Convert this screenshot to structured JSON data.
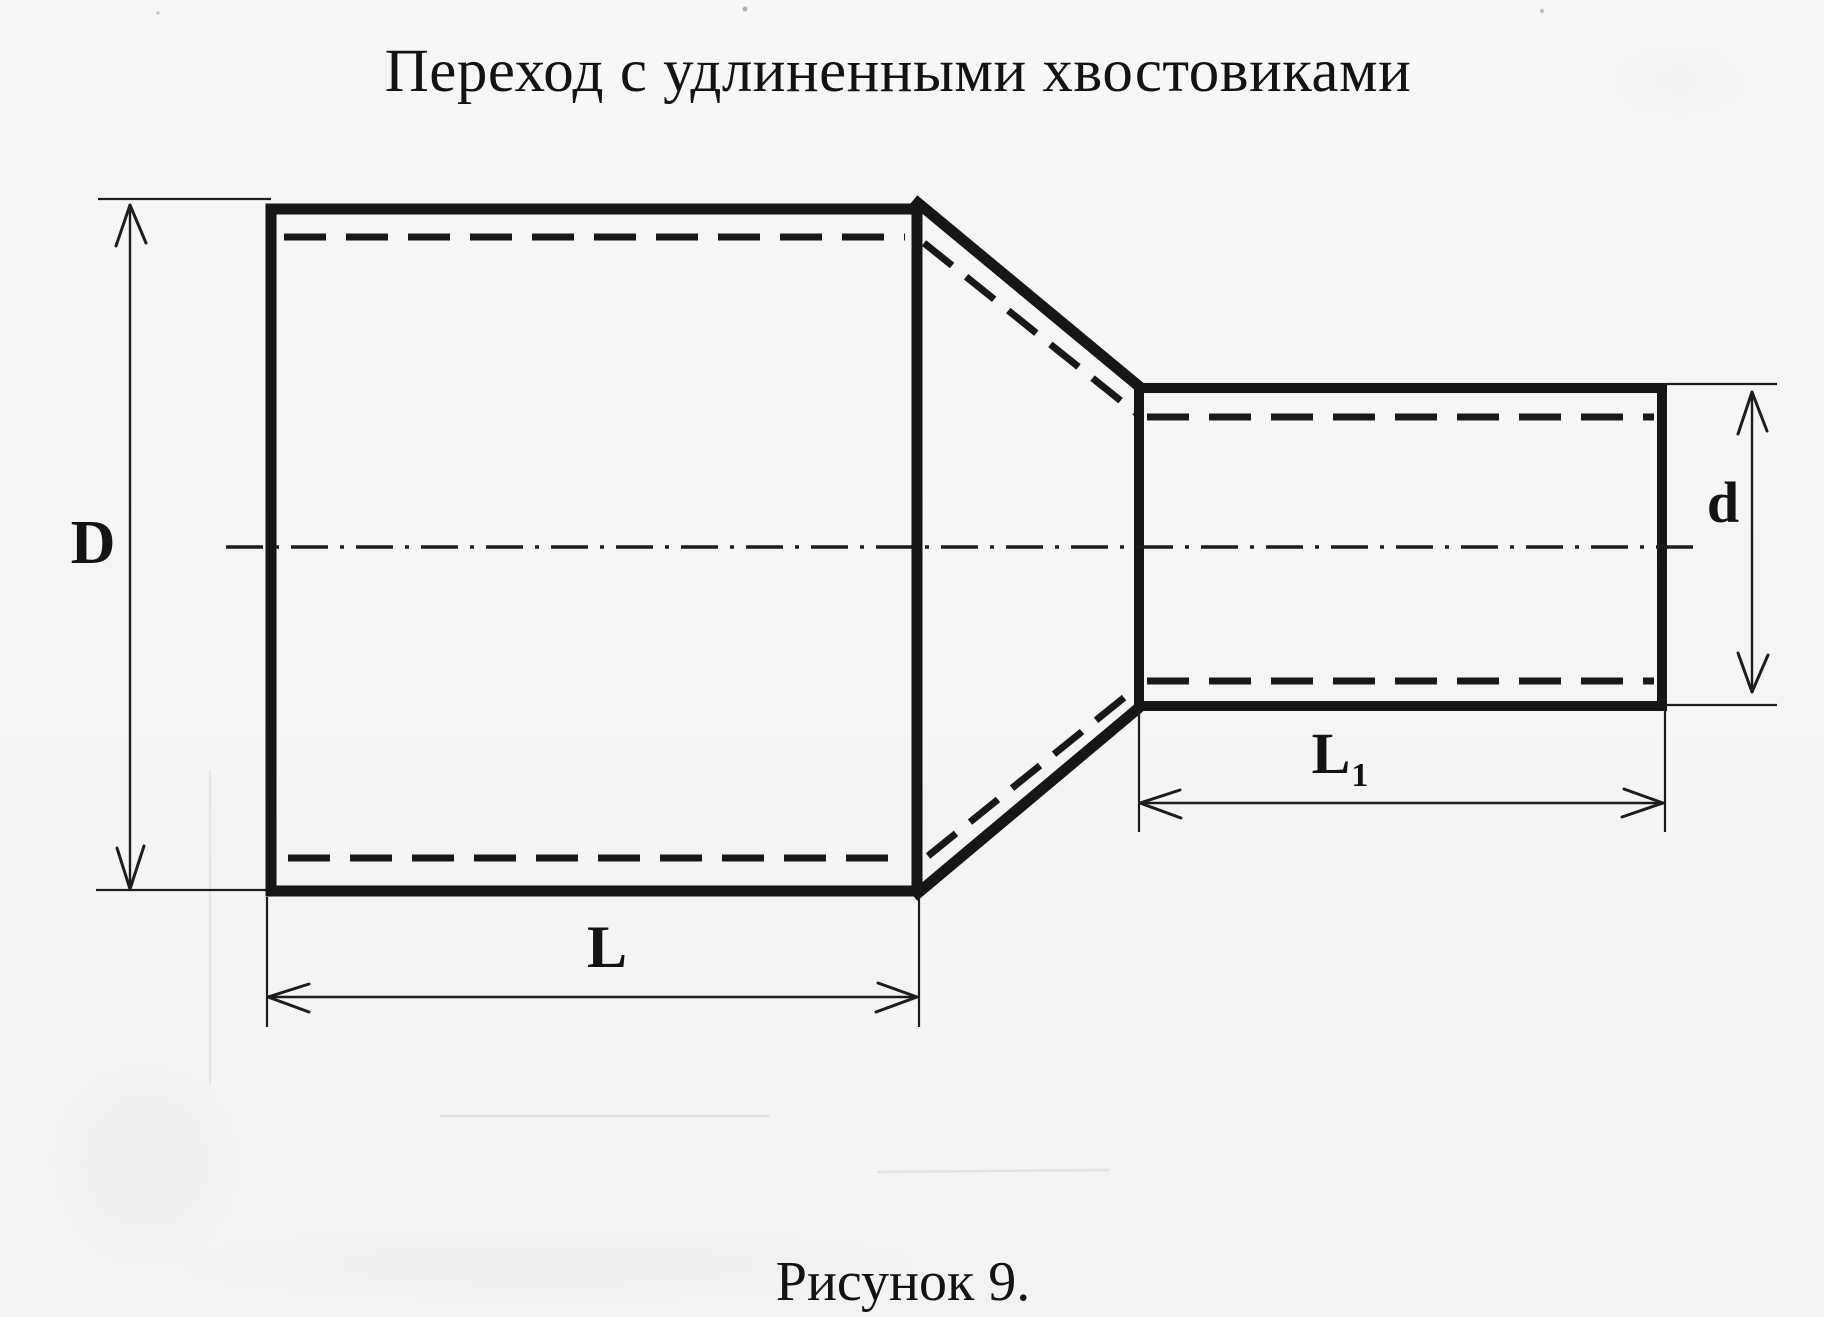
{
  "page": {
    "paper_color": "#f7f6f3",
    "ink_color": "#161616"
  },
  "title": "Переход с удлиненными хвостовиками",
  "caption": "Рисунок 9.",
  "labels": {
    "big_diameter": "D",
    "big_length": "L",
    "small_length_main": "L",
    "small_length_sub": "1",
    "small_diameter": "d"
  }
}
